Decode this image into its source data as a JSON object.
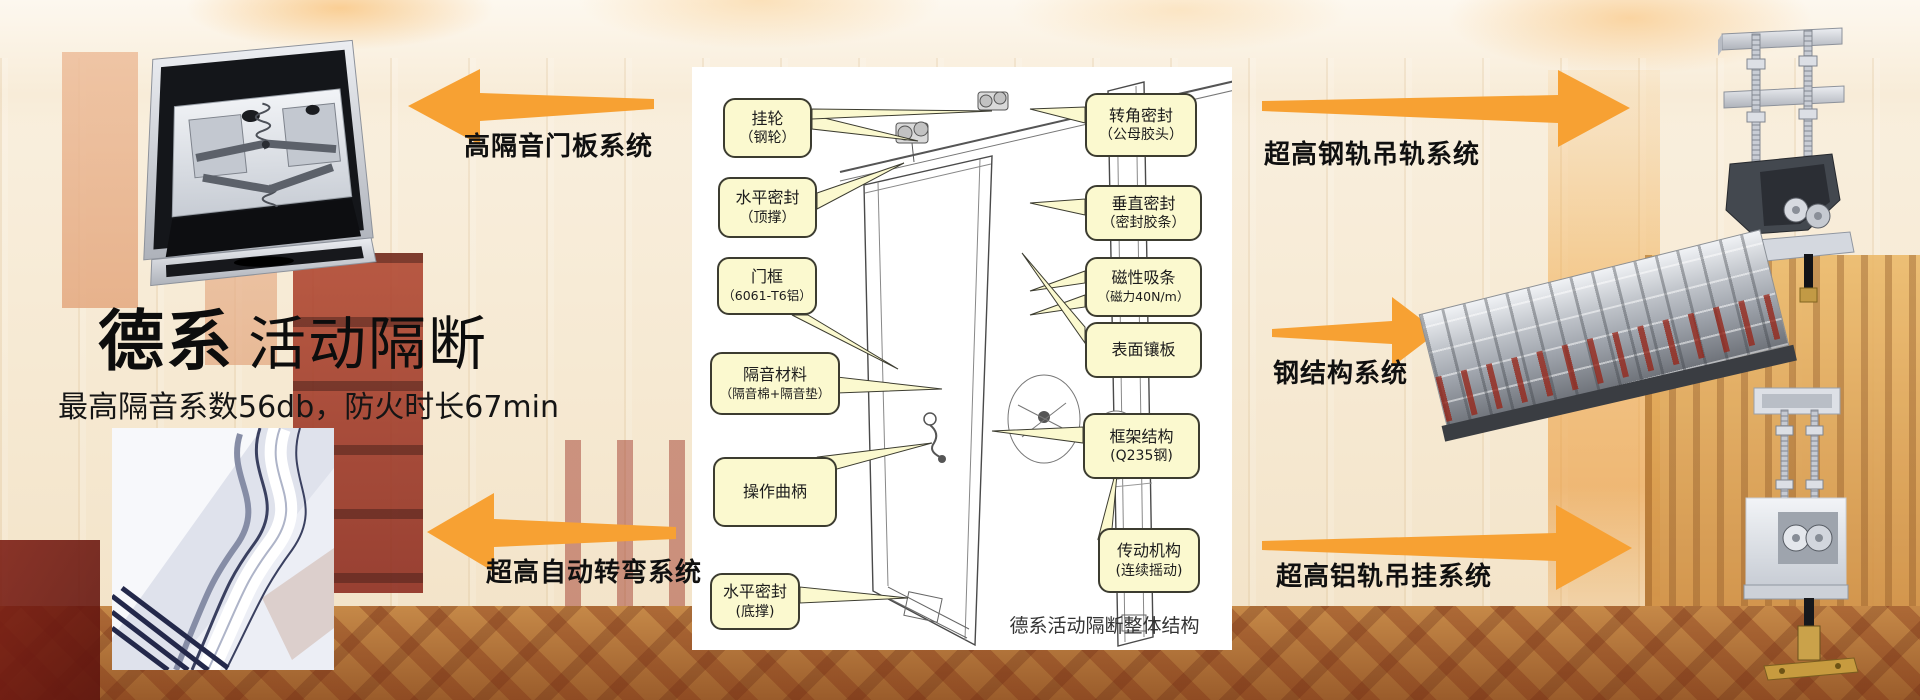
{
  "slide": {
    "accent_color": "#F7A133",
    "callout_fill": "#FBF9CF",
    "title": {
      "brand": "德系",
      "rest": "活动隔断",
      "subtitle": "最高隔音系数56db，防火时长67min"
    },
    "systems": {
      "door_panel": "高隔音门板系统",
      "auto_turn": "超高自动转弯系统",
      "steel_rail": "超高钢轨吊轨系统",
      "steel_structure": "钢结构系统",
      "aluminum_rail": "超高铝轨吊挂系统"
    },
    "diagram": {
      "caption": "德系活动隔断整体结构",
      "callouts_left": [
        {
          "title": "挂轮",
          "sub": "（钢轮）"
        },
        {
          "title": "水平密封",
          "sub": "（顶撑）"
        },
        {
          "title": "门框",
          "sub": "（6061-T6铝）"
        },
        {
          "title": "隔音材料",
          "sub": "（隔音棉+隔音垫）"
        },
        {
          "title": "操作曲柄",
          "sub": ""
        },
        {
          "title": "水平密封",
          "sub": "(底撑)"
        }
      ],
      "callouts_right": [
        {
          "title": "转角密封",
          "sub": "（公母胶头）"
        },
        {
          "title": "垂直密封",
          "sub": "（密封胶条）"
        },
        {
          "title": "磁性吸条",
          "sub": "（磁力40N/m）"
        },
        {
          "title": "表面镶板",
          "sub": ""
        },
        {
          "title": "框架结构",
          "sub": "(Q235钢)"
        },
        {
          "title": "传动机构",
          "sub": "(连续摇动)"
        }
      ]
    }
  }
}
